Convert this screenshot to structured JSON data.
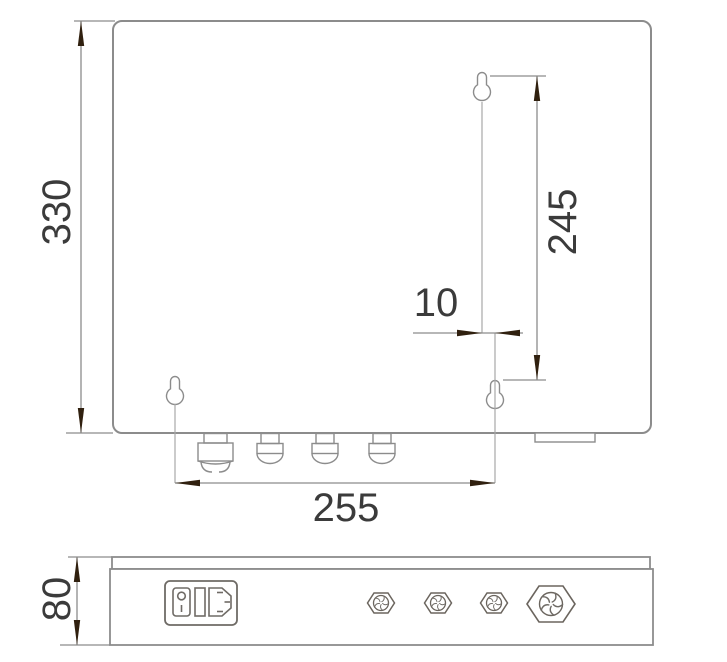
{
  "drawing": {
    "type": "technical-dimension-drawing",
    "views": [
      "front-view",
      "bottom-view"
    ],
    "dimensions": {
      "front_height": "330",
      "keyhole_vertical_spacing": "245",
      "keyhole_horizontal_offset": "10",
      "keyhole_horizontal_spacing": "255",
      "side_depth": "80"
    },
    "icons": {
      "keyhole_slot": "keyhole mounting slot",
      "cable_gland_large": "large cable gland connector",
      "cable_gland_small": "small cable gland connector",
      "hex_gland_fan": "hex cable gland with fan vent face",
      "power_inlet_module": "IEC power inlet with rocker switch and fuse holder"
    },
    "colors": {
      "background": "#ffffff",
      "line": "#8c8c8c",
      "centerline": "#a8a8a8",
      "detail_line": "#6f6b66",
      "arrow": "#30200f",
      "text": "#3b3b3b"
    }
  }
}
